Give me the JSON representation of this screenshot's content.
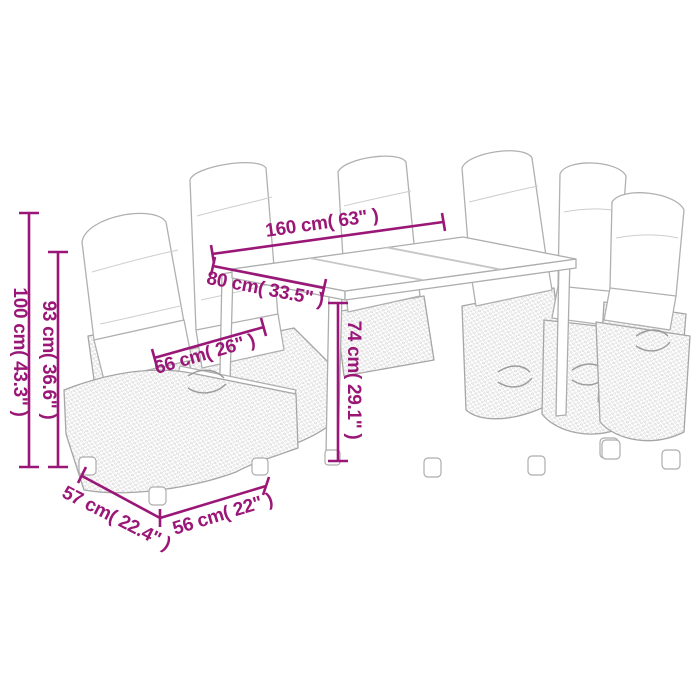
{
  "page": {
    "background": "#ffffff",
    "illustration_alt": "Line-art drawing of an outdoor poly rattan dining set: rectangular table with six reclining chairs with back cushions"
  },
  "colors": {
    "dimension_accent": "#9a1777",
    "line_art": "#adadad"
  },
  "dimensions": {
    "total_height": {
      "label": "100 cm( 43.3\" )"
    },
    "backrest_height": {
      "label": "93 cm( 36.6\" )"
    },
    "table_length": {
      "label": "160 cm( 63\" )"
    },
    "table_width": {
      "label": "80 cm( 33.5\" )"
    },
    "armrest_width": {
      "label": "66 cm( 26\" )"
    },
    "table_height": {
      "label": "74 cm( 29.1\" )"
    },
    "chair_depth": {
      "label": "57 cm( 22.4\" )"
    },
    "chair_width": {
      "label": "56 cm( 22\" )"
    }
  }
}
